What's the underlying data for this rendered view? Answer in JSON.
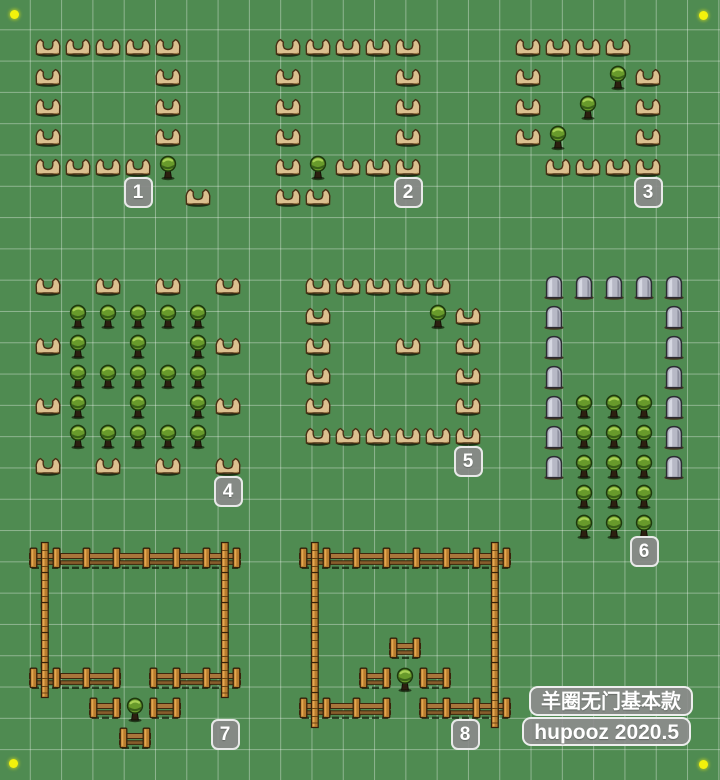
{
  "board": {
    "width": 720,
    "height": 780,
    "grass_color": "#4f8b51",
    "grid_line_color": "rgba(255,255,255,0.36)",
    "grid_cell_px": 31.3,
    "item_step_px": 30
  },
  "watermark": {
    "line1": "羊圈无门基本款",
    "line2": "hupooz 2020.5",
    "badge_bg": "#8c8c8c",
    "badge_border": "#f2f2f2",
    "text_color": "#ffffff"
  },
  "corner_dots": {
    "color": "#f2f20c",
    "centers": [
      [
        14,
        14
      ],
      [
        703,
        15
      ],
      [
        13,
        763
      ],
      [
        703,
        764
      ]
    ]
  },
  "badge_style": {
    "bg": "#8a8a8a",
    "border": "#eeeeee",
    "text_color": "#ffffff"
  },
  "item_types": {
    "hardwood-fence": "hardwood-fence-icon",
    "stone-fence": "stone-fence-icon",
    "bush": "bush-icon",
    "wood-rail": "wood-rail-fence-icon",
    "wood-rail-posted": "wood-rail-fence-end-icon",
    "wood-post": "wood-post-icon"
  },
  "layouts": [
    {
      "id": "layout-1",
      "label": "1",
      "origin": [
        33,
        33
      ],
      "badge_cell": [
        3,
        5
      ],
      "groups": [
        {
          "type": "hardwood-fence",
          "cells": [
            [
              0,
              0
            ],
            [
              1,
              0
            ],
            [
              2,
              0
            ],
            [
              3,
              0
            ],
            [
              4,
              0
            ],
            [
              0,
              1
            ],
            [
              4,
              1
            ],
            [
              0,
              2
            ],
            [
              4,
              2
            ],
            [
              0,
              3
            ],
            [
              4,
              3
            ],
            [
              0,
              4
            ],
            [
              1,
              4
            ],
            [
              2,
              4
            ],
            [
              3,
              4
            ],
            [
              5,
              5
            ]
          ]
        },
        {
          "type": "bush",
          "cells": [
            [
              4,
              4
            ]
          ]
        }
      ]
    },
    {
      "id": "layout-2",
      "label": "2",
      "origin": [
        273,
        33
      ],
      "badge_cell": [
        4,
        5
      ],
      "groups": [
        {
          "type": "hardwood-fence",
          "cells": [
            [
              0,
              0
            ],
            [
              1,
              0
            ],
            [
              2,
              0
            ],
            [
              3,
              0
            ],
            [
              4,
              0
            ],
            [
              0,
              1
            ],
            [
              4,
              1
            ],
            [
              0,
              2
            ],
            [
              4,
              2
            ],
            [
              0,
              3
            ],
            [
              4,
              3
            ],
            [
              0,
              4
            ],
            [
              2,
              4
            ],
            [
              3,
              4
            ],
            [
              4,
              4
            ],
            [
              0,
              5
            ],
            [
              1,
              5
            ]
          ]
        },
        {
          "type": "bush",
          "cells": [
            [
              1,
              4
            ]
          ]
        }
      ]
    },
    {
      "id": "layout-3",
      "label": "3",
      "origin": [
        513,
        33
      ],
      "badge_cell": [
        4,
        5
      ],
      "groups": [
        {
          "type": "hardwood-fence",
          "cells": [
            [
              0,
              0
            ],
            [
              1,
              0
            ],
            [
              2,
              0
            ],
            [
              3,
              0
            ],
            [
              0,
              1
            ],
            [
              4,
              1
            ],
            [
              0,
              2
            ],
            [
              4,
              2
            ],
            [
              0,
              3
            ],
            [
              4,
              3
            ],
            [
              1,
              4
            ],
            [
              2,
              4
            ],
            [
              3,
              4
            ],
            [
              4,
              4
            ]
          ]
        },
        {
          "type": "bush",
          "cells": [
            [
              3,
              1
            ],
            [
              2,
              2
            ],
            [
              1,
              3
            ]
          ]
        }
      ]
    },
    {
      "id": "layout-4",
      "label": "4",
      "origin": [
        33,
        272
      ],
      "badge_cell": [
        6,
        7
      ],
      "groups": [
        {
          "type": "hardwood-fence",
          "cells": [
            [
              0,
              0
            ],
            [
              2,
              0
            ],
            [
              4,
              0
            ],
            [
              6,
              0
            ],
            [
              0,
              2
            ],
            [
              6,
              2
            ],
            [
              0,
              4
            ],
            [
              6,
              4
            ],
            [
              0,
              6
            ],
            [
              2,
              6
            ],
            [
              4,
              6
            ],
            [
              6,
              6
            ]
          ]
        },
        {
          "type": "bush",
          "cells": [
            [
              1,
              1
            ],
            [
              2,
              1
            ],
            [
              3,
              1
            ],
            [
              4,
              1
            ],
            [
              5,
              1
            ],
            [
              1,
              2
            ],
            [
              3,
              2
            ],
            [
              5,
              2
            ],
            [
              1,
              3
            ],
            [
              2,
              3
            ],
            [
              3,
              3
            ],
            [
              4,
              3
            ],
            [
              5,
              3
            ],
            [
              1,
              4
            ],
            [
              3,
              4
            ],
            [
              5,
              4
            ],
            [
              1,
              5
            ],
            [
              2,
              5
            ],
            [
              3,
              5
            ],
            [
              4,
              5
            ],
            [
              5,
              5
            ]
          ]
        }
      ]
    },
    {
      "id": "layout-5",
      "label": "5",
      "origin": [
        303,
        272
      ],
      "badge_cell": [
        5,
        6
      ],
      "groups": [
        {
          "type": "hardwood-fence",
          "cells": [
            [
              0,
              0
            ],
            [
              1,
              0
            ],
            [
              2,
              0
            ],
            [
              3,
              0
            ],
            [
              4,
              0
            ],
            [
              0,
              1
            ],
            [
              5,
              1
            ],
            [
              0,
              2
            ],
            [
              3,
              2
            ],
            [
              5,
              2
            ],
            [
              0,
              3
            ],
            [
              5,
              3
            ],
            [
              0,
              4
            ],
            [
              5,
              4
            ],
            [
              0,
              5
            ],
            [
              1,
              5
            ],
            [
              2,
              5
            ],
            [
              3,
              5
            ],
            [
              4,
              5
            ],
            [
              5,
              5
            ]
          ]
        },
        {
          "type": "bush",
          "cells": [
            [
              4,
              1
            ]
          ]
        }
      ]
    },
    {
      "id": "layout-6",
      "label": "6",
      "origin": [
        539,
        272
      ],
      "badge_cell": [
        3,
        9
      ],
      "groups": [
        {
          "type": "stone-fence",
          "cells": [
            [
              0,
              0
            ],
            [
              1,
              0
            ],
            [
              2,
              0
            ],
            [
              3,
              0
            ],
            [
              4,
              0
            ],
            [
              0,
              1
            ],
            [
              4,
              1
            ],
            [
              0,
              2
            ],
            [
              4,
              2
            ],
            [
              0,
              3
            ],
            [
              4,
              3
            ],
            [
              0,
              4
            ],
            [
              4,
              4
            ],
            [
              0,
              5
            ],
            [
              4,
              5
            ],
            [
              0,
              6
            ],
            [
              4,
              6
            ]
          ]
        },
        {
          "type": "bush",
          "cells": [
            [
              1,
              4
            ],
            [
              2,
              4
            ],
            [
              3,
              4
            ],
            [
              1,
              5
            ],
            [
              2,
              5
            ],
            [
              3,
              5
            ],
            [
              1,
              6
            ],
            [
              2,
              6
            ],
            [
              3,
              6
            ],
            [
              1,
              7
            ],
            [
              2,
              7
            ],
            [
              3,
              7
            ],
            [
              1,
              8
            ],
            [
              2,
              8
            ],
            [
              3,
              8
            ]
          ]
        }
      ]
    },
    {
      "id": "layout-7",
      "label": "7",
      "origin": [
        30,
        545
      ],
      "badge_cell": [
        6,
        6
      ],
      "groups": [
        {
          "type": "wood-rail",
          "cells": [
            [
              1,
              0
            ],
            [
              2,
              0
            ],
            [
              3,
              0
            ],
            [
              4,
              0
            ],
            [
              5,
              0
            ],
            [
              6,
              0
            ],
            [
              1,
              4
            ],
            [
              2,
              4
            ],
            [
              5,
              4
            ],
            [
              6,
              4
            ]
          ]
        },
        {
          "type": "wood-rail-posted",
          "cells": [
            [
              0,
              0
            ],
            [
              0,
              4
            ],
            [
              4,
              4
            ],
            [
              2,
              5
            ],
            [
              4,
              5
            ],
            [
              3,
              6
            ]
          ]
        },
        {
          "type": "wood-post",
          "cells": [
            [
              0,
              0
            ],
            [
              0,
              1
            ],
            [
              0,
              2
            ],
            [
              0,
              3
            ],
            [
              0,
              4
            ],
            [
              6,
              0
            ],
            [
              6,
              1
            ],
            [
              6,
              2
            ],
            [
              6,
              3
            ],
            [
              6,
              4
            ]
          ]
        },
        {
          "type": "bush",
          "cells": [
            [
              3,
              5
            ]
          ]
        }
      ]
    },
    {
      "id": "layout-8",
      "label": "8",
      "origin": [
        300,
        545
      ],
      "badge_cell": [
        5,
        6
      ],
      "groups": [
        {
          "type": "wood-rail",
          "cells": [
            [
              1,
              0
            ],
            [
              2,
              0
            ],
            [
              3,
              0
            ],
            [
              4,
              0
            ],
            [
              5,
              0
            ],
            [
              6,
              0
            ],
            [
              1,
              5
            ],
            [
              2,
              5
            ],
            [
              5,
              5
            ],
            [
              6,
              5
            ]
          ]
        },
        {
          "type": "wood-rail-posted",
          "cells": [
            [
              0,
              0
            ],
            [
              3,
              3
            ],
            [
              2,
              4
            ],
            [
              4,
              4
            ],
            [
              0,
              5
            ],
            [
              4,
              5
            ]
          ]
        },
        {
          "type": "wood-post",
          "cells": [
            [
              0,
              0
            ],
            [
              0,
              1
            ],
            [
              0,
              2
            ],
            [
              0,
              3
            ],
            [
              0,
              4
            ],
            [
              0,
              5
            ],
            [
              6,
              0
            ],
            [
              6,
              1
            ],
            [
              6,
              2
            ],
            [
              6,
              3
            ],
            [
              6,
              4
            ],
            [
              6,
              5
            ]
          ]
        },
        {
          "type": "bush",
          "cells": [
            [
              3,
              4
            ]
          ]
        }
      ]
    }
  ]
}
